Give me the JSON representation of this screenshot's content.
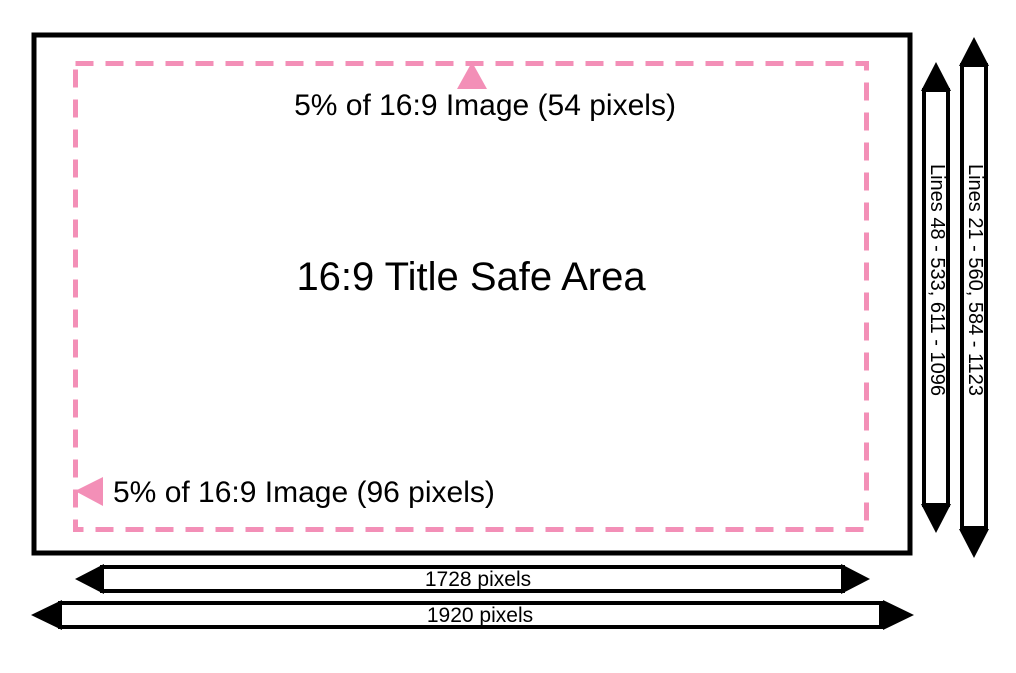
{
  "diagram": {
    "title": "16:9 Title Safe Area",
    "annotations": {
      "top_margin": "5% of 16:9 Image (54 pixels)",
      "left_margin": "5% of 16:9 Image (96 pixels)"
    },
    "dimension_bars": {
      "safe_lines_label": "Lines 48 - 533, 611 - 1096",
      "full_lines_label": "Lines 21 - 560, 584 - 1123",
      "safe_width_label": "1728 pixels",
      "full_width_label": "1920 pixels"
    },
    "colors": {
      "accent_pink": "#F38FB7",
      "line_black": "#000000",
      "background": "#FFFFFF"
    }
  }
}
